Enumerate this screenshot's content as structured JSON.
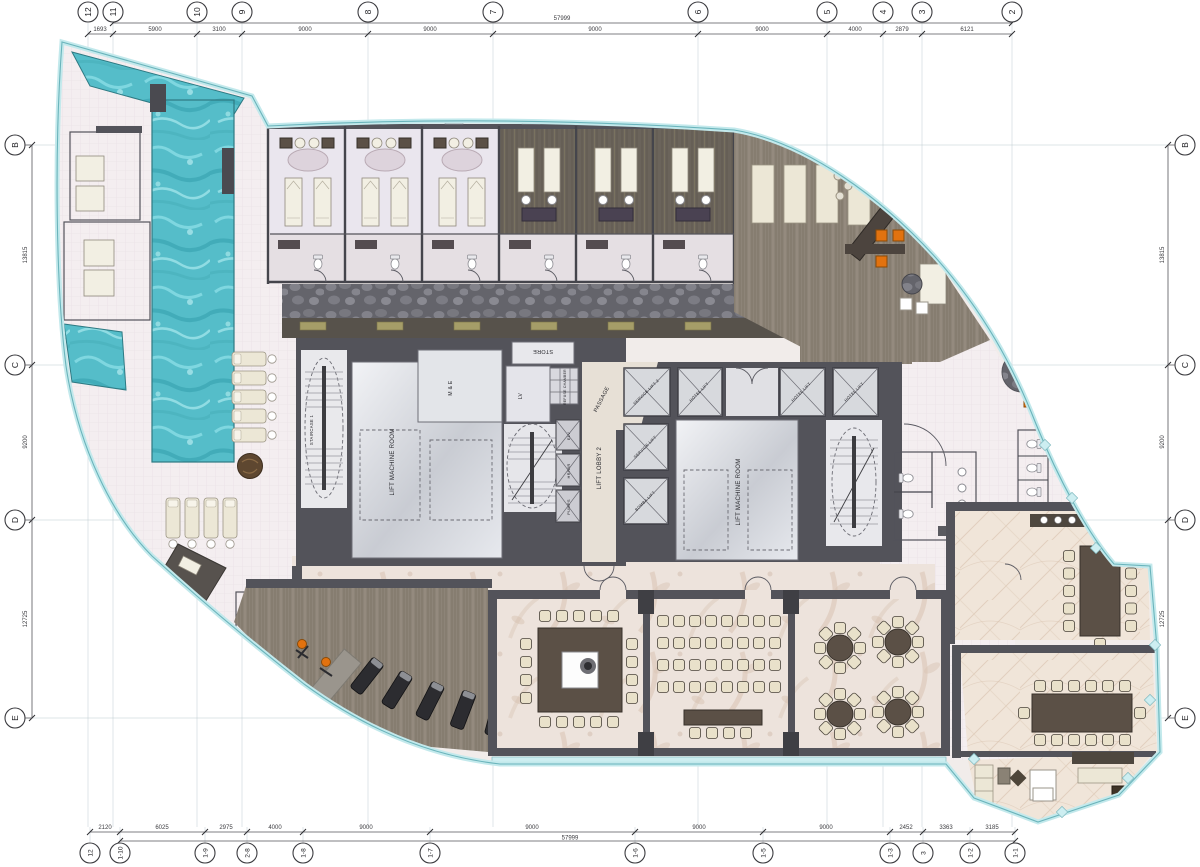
{
  "drawing_type": "hotel amenities floor plan",
  "grid": {
    "top_markers": [
      "12",
      "11",
      "10",
      "9",
      "8",
      "7",
      "6",
      "5",
      "4",
      "3",
      "2"
    ],
    "top_dims": [
      "1693",
      "5900",
      "3100",
      "9000",
      "9000",
      "9000",
      "9000",
      "4000",
      "2879",
      "6121"
    ],
    "top_overall": "57999",
    "bottom_markers": [
      "12",
      "1-10",
      "1-9",
      "2-8",
      "1-8",
      "1-7",
      "1-6",
      "1-5",
      "1-3",
      "3",
      "1-2",
      "1-1"
    ],
    "bottom_dims": [
      "2120",
      "6025",
      "2975",
      "4000",
      "9000",
      "9000",
      "9000",
      "9000",
      "2452",
      "3363",
      "3185"
    ],
    "bottom_overall": "57999",
    "left_markers": [
      "B",
      "C",
      "D",
      "E"
    ],
    "left_dims": [
      "13815",
      "9200",
      "12725"
    ],
    "right_markers": [
      "B",
      "C",
      "D",
      "E"
    ],
    "right_dims": [
      "13815",
      "9200",
      "12725"
    ]
  },
  "rooms": {
    "staircase_1": "STAIRCASE 1",
    "lift_machine_room": "LIFT MACHINE ROOM",
    "m_and_e": "M & E",
    "store": "STORE",
    "lv": "LV",
    "refuse_chamber": "REFUSE CHAMBER",
    "passage": "PASSAGE",
    "lift_lobby_2": "LIFT LOBBY 2",
    "elv": "ELV",
    "hr_wr": "HR/WR",
    "pumps": "PUMPS",
    "service_lift_2": "SERVICE LIFT 2",
    "service_lift": "SERVICE LIFT",
    "bomba_lift": "BOMBA LIFT",
    "hotel_lift": "HOTEL LIFT"
  },
  "colors": {
    "water": "#55bdc9",
    "glass": "#cdeef1",
    "wall": "#53535a",
    "wood": "#8a8176",
    "wood_dark": "#6a635a",
    "carpet": "#ede3dc",
    "deck_tile": "#f4eef0",
    "accent_orange": "#e2720f"
  }
}
